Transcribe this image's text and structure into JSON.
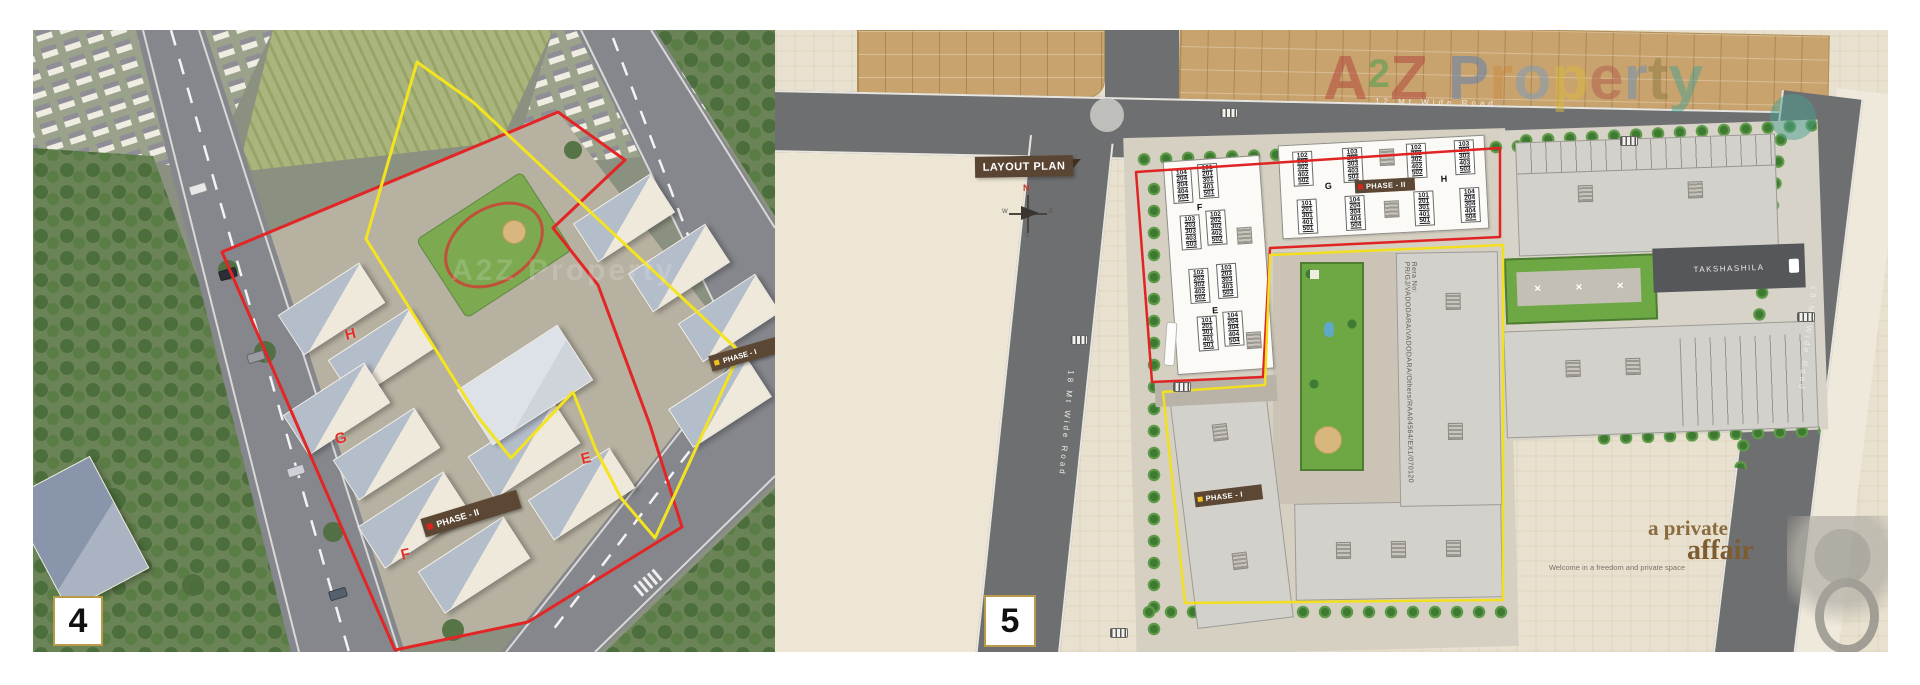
{
  "watermark": {
    "text": "A2Z Property"
  },
  "panel4": {
    "number": "4",
    "labels": {
      "phase1": "PHASE - I",
      "phase2": "PHASE - II",
      "h": "H",
      "g": "G",
      "f": "F",
      "e": "E"
    }
  },
  "panel5": {
    "number": "5",
    "banner": "LAYOUT PLAN",
    "compass": {
      "n": "N",
      "e": "E",
      "s": "S",
      "w": "W"
    },
    "labels": {
      "phase1": "PHASE - I",
      "phase2": "PHASE - II",
      "e": "E",
      "f": "F",
      "g": "G",
      "h": "H"
    },
    "roads": {
      "top": "12 Mt Wide Road",
      "left": "18 Mt Wide Road",
      "right": "18 Mt Wide Road"
    },
    "rera": "Rera No: PR/GJ/VADODARA/VADODARA/Others/RAA04564/EX1/070120",
    "neighbor_label": "TAKSHASHILA",
    "stacks": {
      "s101": "101\n201\n301\n401\n501",
      "s102": "102\n202\n302\n402\n502",
      "s103": "103\n203\n303\n403\n503",
      "s104": "104\n204\n304\n404\n504"
    },
    "tagline": {
      "line1": "a private",
      "line2": "affair",
      "sub": "Welcome in a freedom and private space"
    },
    "watermark_letters": [
      {
        "ch": "A",
        "c": "#b04038"
      },
      {
        "ch": "2",
        "c": "#3f9e4d"
      },
      {
        "ch": "Z",
        "c": "#b04038"
      },
      {
        "ch": "P",
        "c": "#5b7fb5"
      },
      {
        "ch": "r",
        "c": "#c98a3e"
      },
      {
        "ch": "o",
        "c": "#7a9bbf"
      },
      {
        "ch": "p",
        "c": "#d9b93e"
      },
      {
        "ch": "e",
        "c": "#b05a4a"
      },
      {
        "ch": "r",
        "c": "#6b8fb5"
      },
      {
        "ch": "t",
        "c": "#8a7a45"
      },
      {
        "ch": "y",
        "c": "#49a08f"
      }
    ],
    "table_icon": "✕",
    "colors": {
      "boundary_phase2": "#e32526",
      "boundary_phase1": "#f4e320",
      "phase_box": "#5b4733"
    }
  }
}
